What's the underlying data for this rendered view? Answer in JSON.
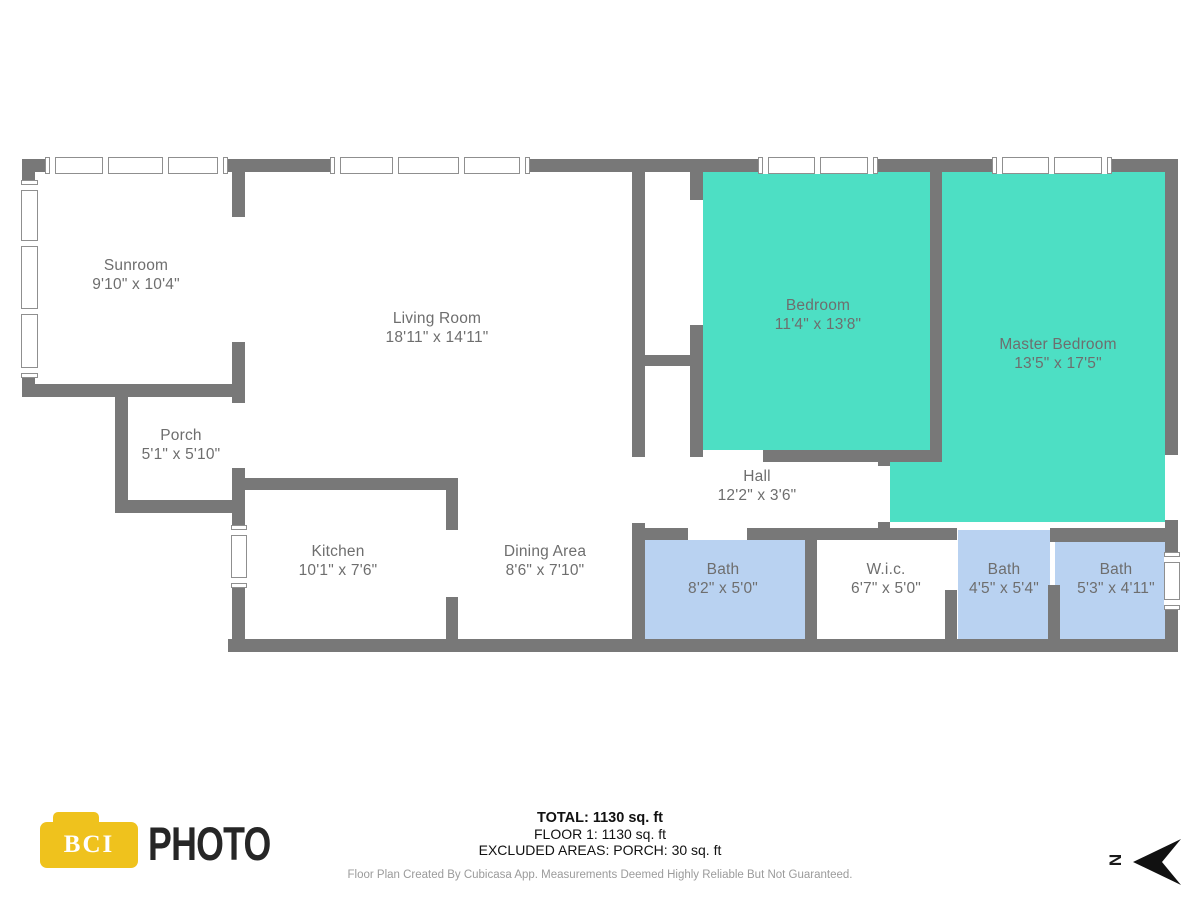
{
  "rooms": [
    {
      "name": "Sunroom",
      "dims": "9'10\" x 10'4\""
    },
    {
      "name": "Living Room",
      "dims": "18'11\" x 14'11\""
    },
    {
      "name": "Porch",
      "dims": "5'1\" x 5'10\""
    },
    {
      "name": "Kitchen",
      "dims": "10'1\" x 7'6\""
    },
    {
      "name": "Dining Area",
      "dims": "8'6\" x 7'10\""
    },
    {
      "name": "Hall",
      "dims": "12'2\" x 3'6\""
    },
    {
      "name": "Bedroom",
      "dims": "11'4\" x 13'8\""
    },
    {
      "name": "Master Bedroom",
      "dims": "13'5\" x 17'5\""
    },
    {
      "name": "Bath",
      "dims": "8'2\" x 5'0\""
    },
    {
      "name": "W.i.c.",
      "dims": "6'7\" x 5'0\""
    },
    {
      "name": "Bath",
      "dims": "4'5\" x 5'4\""
    },
    {
      "name": "Bath",
      "dims": "5'3\" x 4'11\""
    }
  ],
  "footer": {
    "total": "TOTAL: 1130 sq. ft",
    "floor": "FLOOR 1: 1130 sq. ft",
    "excluded": "EXCLUDED AREAS: PORCH: 30 sq. ft",
    "disclaimer": "Floor Plan Created By Cubicasa App. Measurements Deemed Highly Reliable But Not Guaranteed.",
    "compass_letter": "N"
  },
  "logo": {
    "badge": "BCI",
    "brand": "PHOTO"
  },
  "colors": {
    "wall": "#787878",
    "bedroom_fill": "#4DDFC4",
    "bath_fill": "#B9D2F1",
    "label_text": "#6e6e6e",
    "logo_yellow": "#EFC21D",
    "disclaimer_text": "#9b9b9b"
  }
}
